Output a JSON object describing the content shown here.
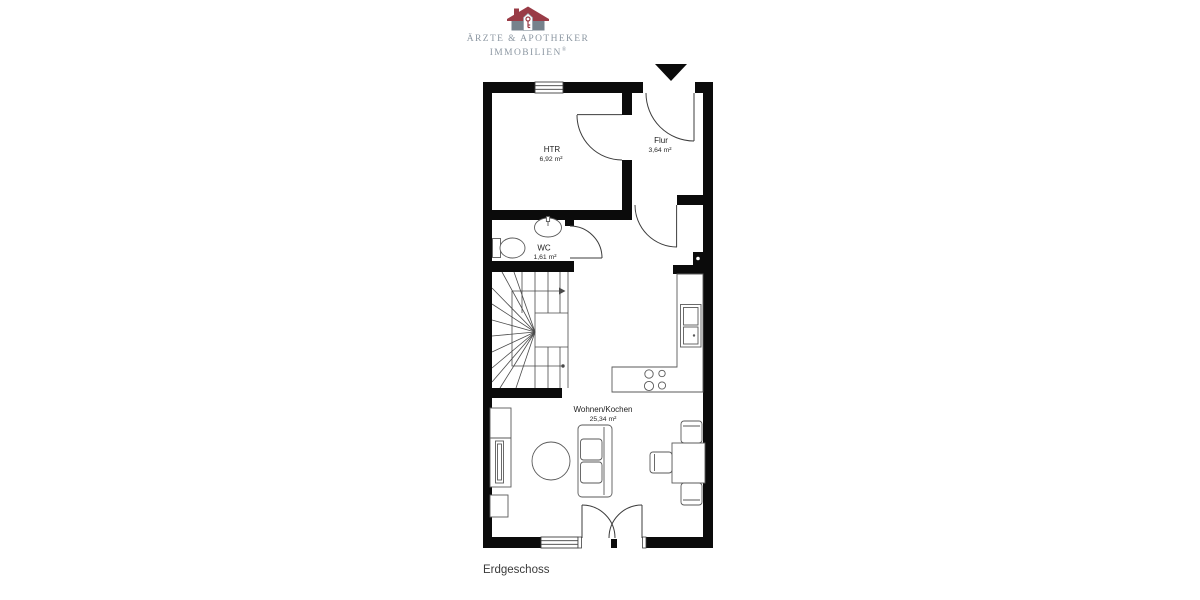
{
  "brand": {
    "line1": "ÄRZTE & APOTHEKER",
    "line2": "IMMOBILIEN",
    "registered": "®",
    "colors": {
      "roof": "#993b46",
      "house_walls": "#76828c",
      "text": "#8c97a2"
    }
  },
  "plan": {
    "title": "Erdgeschoss",
    "wall_color": "#0b0b0b",
    "rooms": [
      {
        "name": "HTR",
        "area": "6,92 m²"
      },
      {
        "name": "Flur",
        "area": "3,64 m²"
      },
      {
        "name": "WC",
        "area": "1,61 m²"
      },
      {
        "name": "Wohnen/Kochen",
        "area": "25,34 m²"
      }
    ],
    "symbols": [
      "entrance-arrow-icon",
      "window-icon",
      "door-swing-icon",
      "stairs-icon",
      "toilet-icon",
      "washbasin-icon",
      "kitchen-sink-icon",
      "cooktop-icon",
      "sofa-icon",
      "coffee-table-icon",
      "dining-table-icon",
      "dining-chair-icon",
      "tv-sideboard-icon",
      "french-doors-icon"
    ]
  }
}
